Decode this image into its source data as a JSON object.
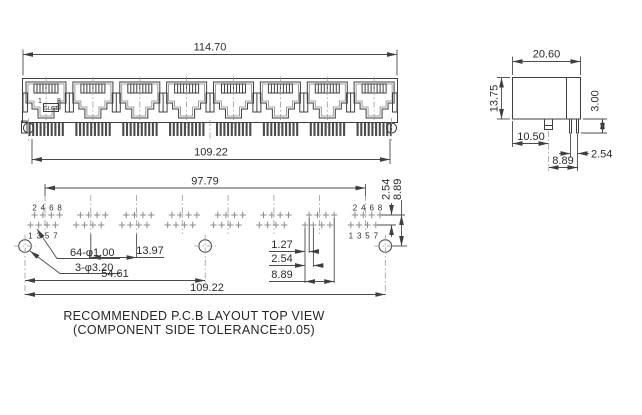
{
  "front_view": {
    "dim_overall_width": "114.70",
    "dim_pin_row_span": "109.22",
    "port1_pin1_label": "1",
    "port1_pin8_label": "8",
    "logo_text": "GLGT"
  },
  "side_view": {
    "dim_depth": "20.60",
    "dim_height": "13.75",
    "dim_pin_protrusion": "3.00",
    "dim_peg_from_front": "10.50",
    "dim_pin_pitch": "2.54",
    "dim_peg_to_pins": "8.89"
  },
  "pcb_view": {
    "dim_port_centers_span": "97.79",
    "dim_row_pitch": "2.54",
    "dim_row_to_hole": "8.89",
    "dim_port_pitch": "13.97",
    "note_pin_holes": "64-φ1.00",
    "note_mounting_holes": "3-φ3.20",
    "dim_half_span": "54.61",
    "dim_mount_hole_span": "109.22",
    "dim_stagger": "1.27",
    "dim_pitch": "2.54",
    "dim_group_span": "8.89",
    "top_row_labels": [
      "2",
      "4",
      "6",
      "8"
    ],
    "bottom_row_labels": [
      "1",
      "3",
      "5",
      "7"
    ]
  },
  "title": {
    "line1": "RECOMMENDED P.C.B LAYOUT TOP VIEW",
    "line2": "(COMPONENT SIDE TOLERANCE±0.05)"
  },
  "colors": {
    "line": "#3f3f3f",
    "pin_mark": "#8c8c8c",
    "text": "#2b2b2b",
    "background": "#ffffff"
  }
}
